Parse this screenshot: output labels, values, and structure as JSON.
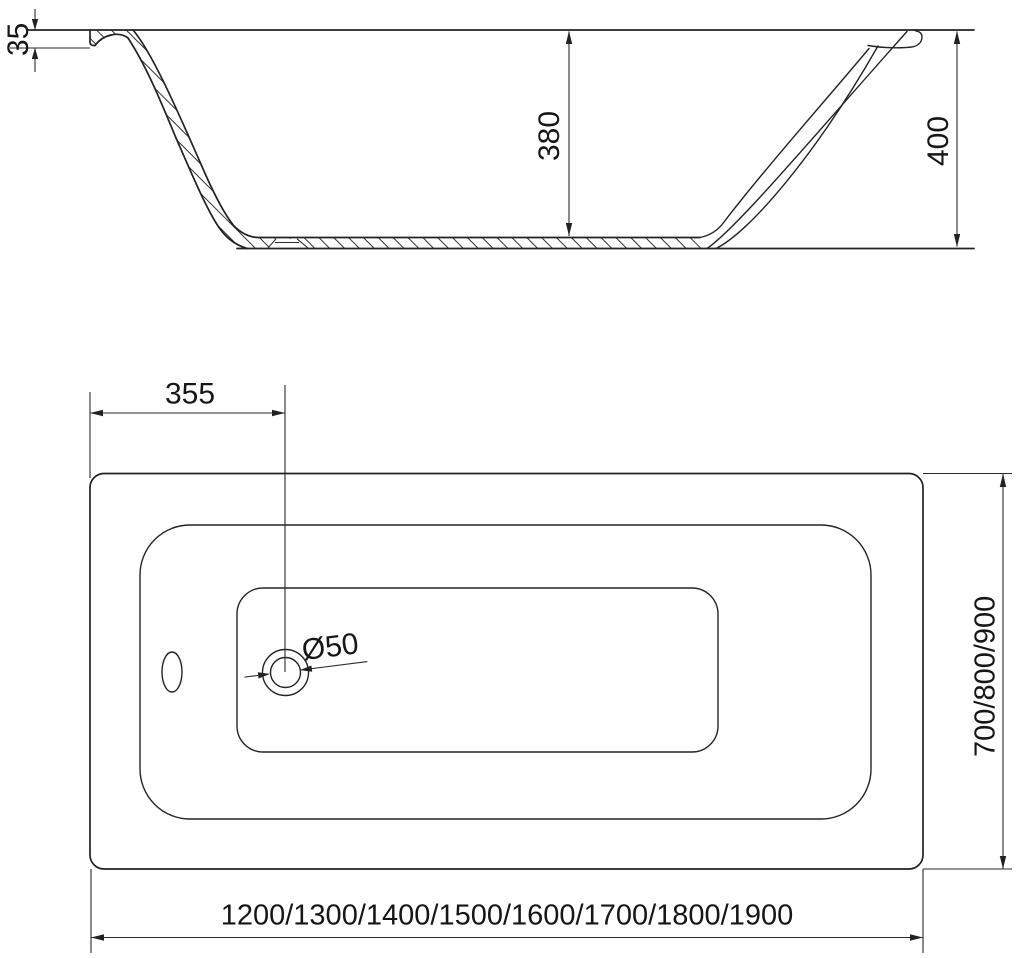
{
  "drawing": {
    "background": "#ffffff",
    "line_color": "#222222",
    "views": {
      "side_section": "bathtub-side-section",
      "top_plan": "bathtub-top-plan"
    }
  },
  "labels": {
    "rim_lip_height": "35",
    "inner_depth": "380",
    "overall_height": "400",
    "drain_offset": "355",
    "drain_diameter": "Ø50",
    "width_variants": "700/800/900",
    "length_variants": "1200/1300/1400/1500/1600/1700/1800/1900"
  }
}
